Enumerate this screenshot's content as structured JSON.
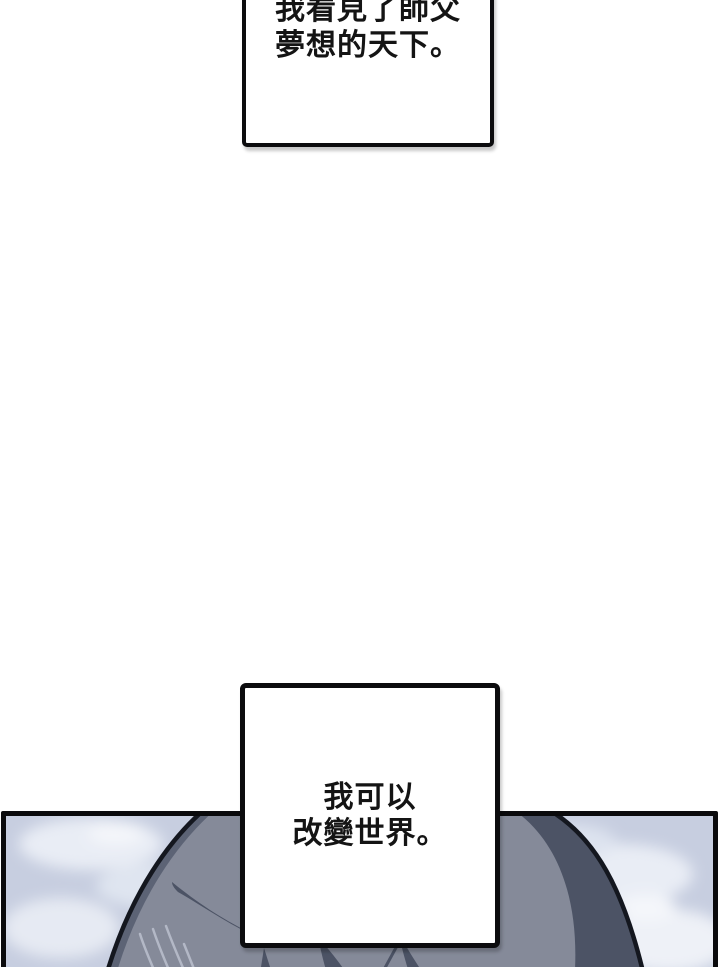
{
  "comic": {
    "narration_boxes": [
      {
        "lines": [
          "我看見了師父",
          "夢想的天下。"
        ]
      },
      {
        "lines": [
          "我可以",
          "改變世界。"
        ]
      }
    ],
    "panel": {
      "scene": "back of a grey-haired head rising into a pale cloudy sky",
      "colors": {
        "sky": "#c7cee0",
        "cloud_light": "#eef1f7",
        "hair_base": "#858a99",
        "hair_shadow": "#4c5365",
        "hair_rim": "#5c6375",
        "hair_highlight": "#b3b8c6",
        "line_color": "#14171f",
        "panel_border": "#0a0a0c"
      }
    },
    "box_style": {
      "border_color": "#0c0c0e",
      "fill_color": "#ffffff",
      "text_color": "#141414"
    }
  }
}
